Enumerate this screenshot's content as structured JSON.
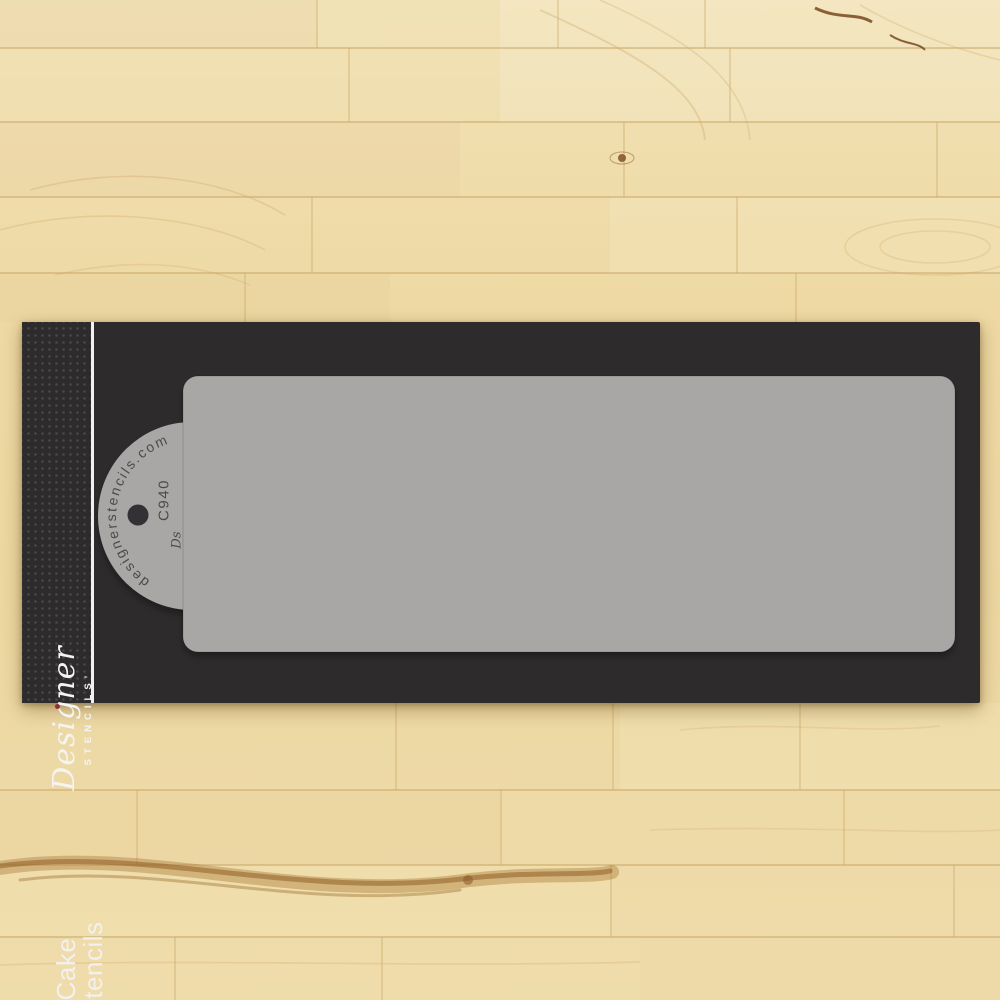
{
  "brand": {
    "script": "Designer",
    "caps": "STENCILS’"
  },
  "product": {
    "line1": "Cake",
    "line2": "Stencils"
  },
  "tab": {
    "url": "designerstencils.com",
    "code": "C940",
    "monogram": "Ds"
  },
  "stencil": {
    "pattern": {
      "motif": "art-deco-fan-plume",
      "rows_visible": 3,
      "fans_per_row": 10
    }
  },
  "colors": {
    "wood_base": "#ecd9a4",
    "wood_light": "#f4e8c2",
    "wood_dark": "#e3cc96",
    "wood_seam": "#c9a96b",
    "wood_streak": "#9c6b33",
    "card": "#2d2b2c",
    "card_dot": "#4b4647",
    "separator_white": "#f2f1ef",
    "stencil_gray": "#a8a7a5",
    "cutout_dark": "#3a383b",
    "stencil_text": "#4c4a4c",
    "hole": "#333134",
    "logo_red": "#8e2f3c"
  }
}
